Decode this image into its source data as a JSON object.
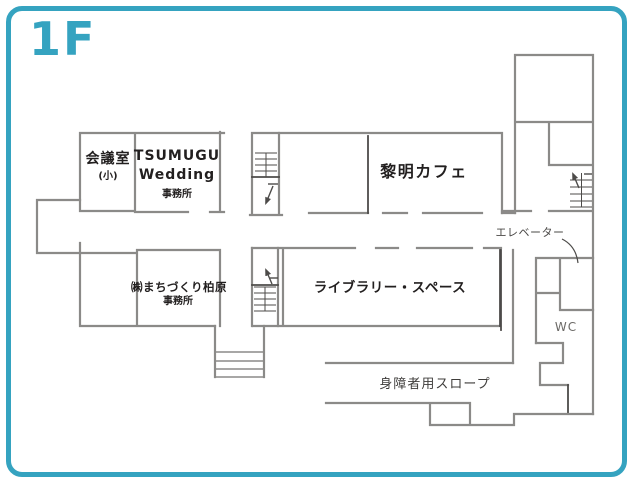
{
  "page": {
    "floor_label": "1F"
  },
  "colors": {
    "accent": "#35a3c0",
    "wall": "#8b8a88",
    "detail": "#4d4b49",
    "text": "#221f1f"
  },
  "rooms": {
    "meeting": {
      "name": "会議室",
      "sub": "(小)"
    },
    "tsumugu": {
      "line1": "TSUMUGU",
      "line2": "Wedding",
      "sub": "事務所"
    },
    "cafe": {
      "name": "黎明カフェ"
    },
    "machizukuri": {
      "name": "㈱まちづくり柏原",
      "sub": "事務所"
    },
    "library": {
      "name": "ライブラリー・スペース"
    }
  },
  "facilities": {
    "elevator": "エレベーター",
    "wc": "WC",
    "ramp": "身障者用スロープ"
  }
}
